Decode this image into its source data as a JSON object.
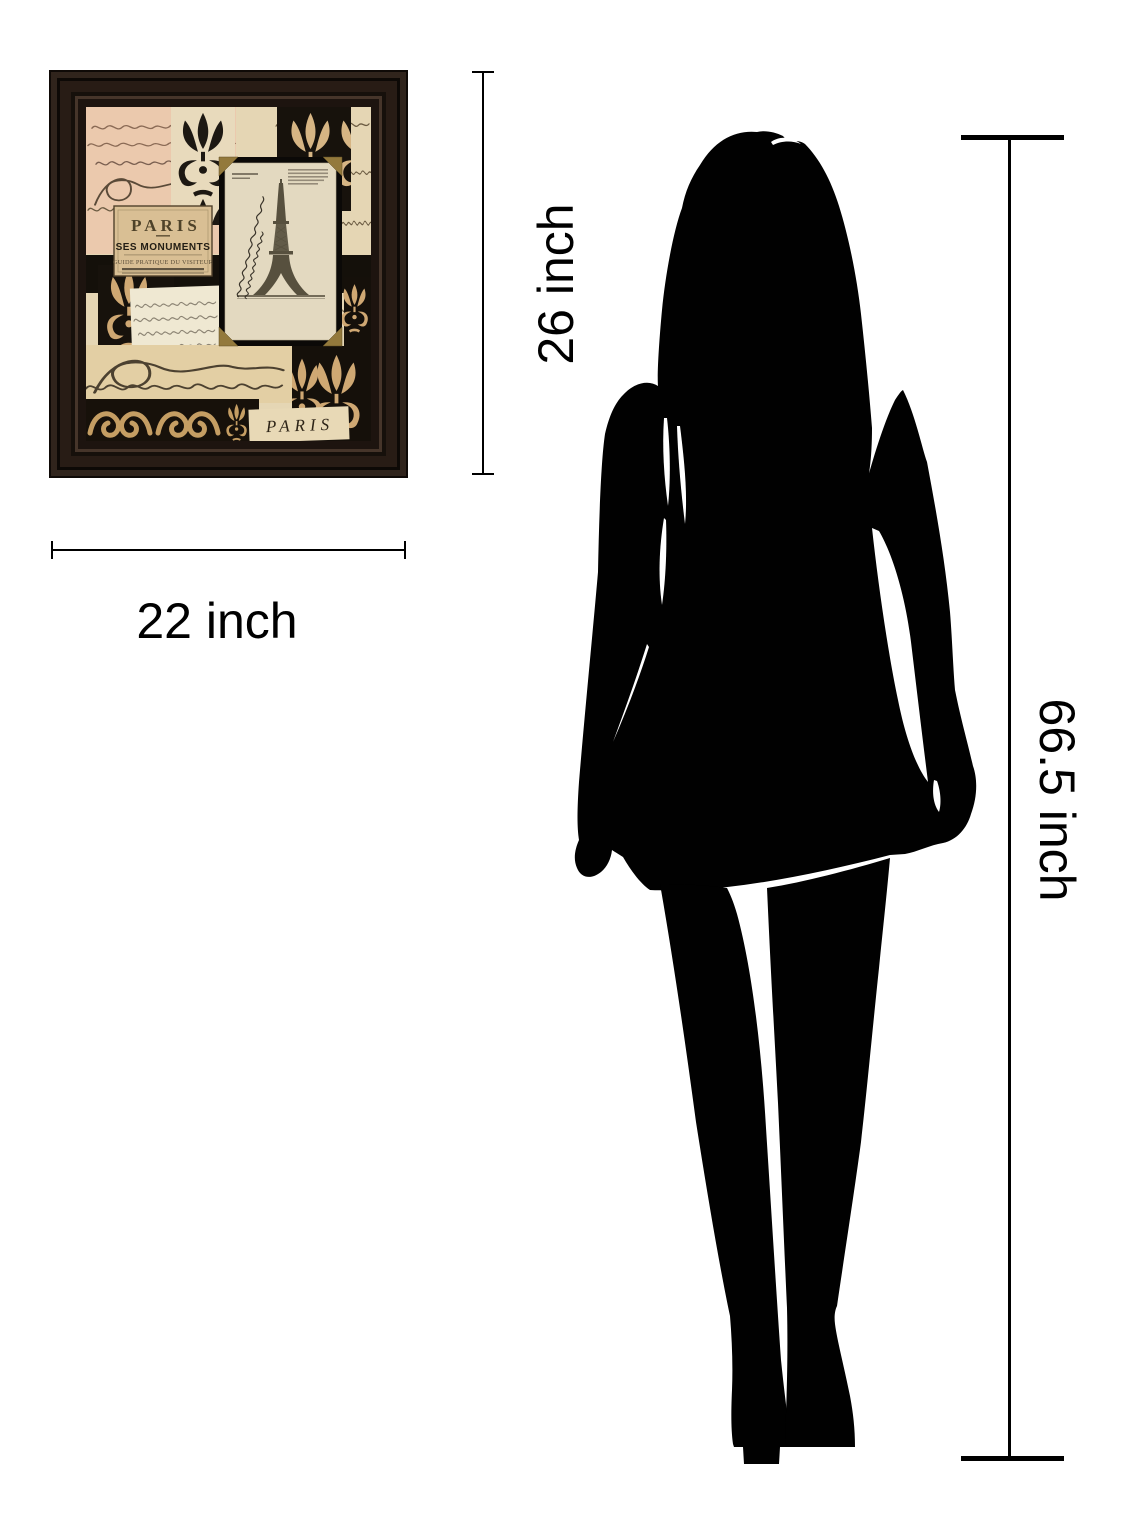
{
  "image": {
    "background": "#ffffff"
  },
  "framed_print": {
    "frame_color": "#241a13",
    "poster_label": {
      "title": "PARIS",
      "subtitle": "SES MONUMENTS",
      "tagline": "GUIDE PRATIQUE DU VISITEUR"
    },
    "bottom_caption": "PARIS",
    "palette": {
      "paper_cream": "#e5d6b4",
      "paper_blush": "#ebc9ad",
      "paper_white": "#efe8d2",
      "damask_tan": "#cfa873",
      "panel_black": "#17120c",
      "mat_black": "#0b0907",
      "postcard_paper": "#e3d9c0",
      "gold_corner": "#93793c",
      "script_ink": "#5a4a38",
      "tower_ink": "#57503e"
    }
  },
  "dimensions": {
    "width_label": "22 inch",
    "height_label": "26 inch",
    "person_height_label": "66.5 inch",
    "line_color": "#000000"
  },
  "silhouette": {
    "subject": "standing-woman",
    "color": "#010101"
  }
}
